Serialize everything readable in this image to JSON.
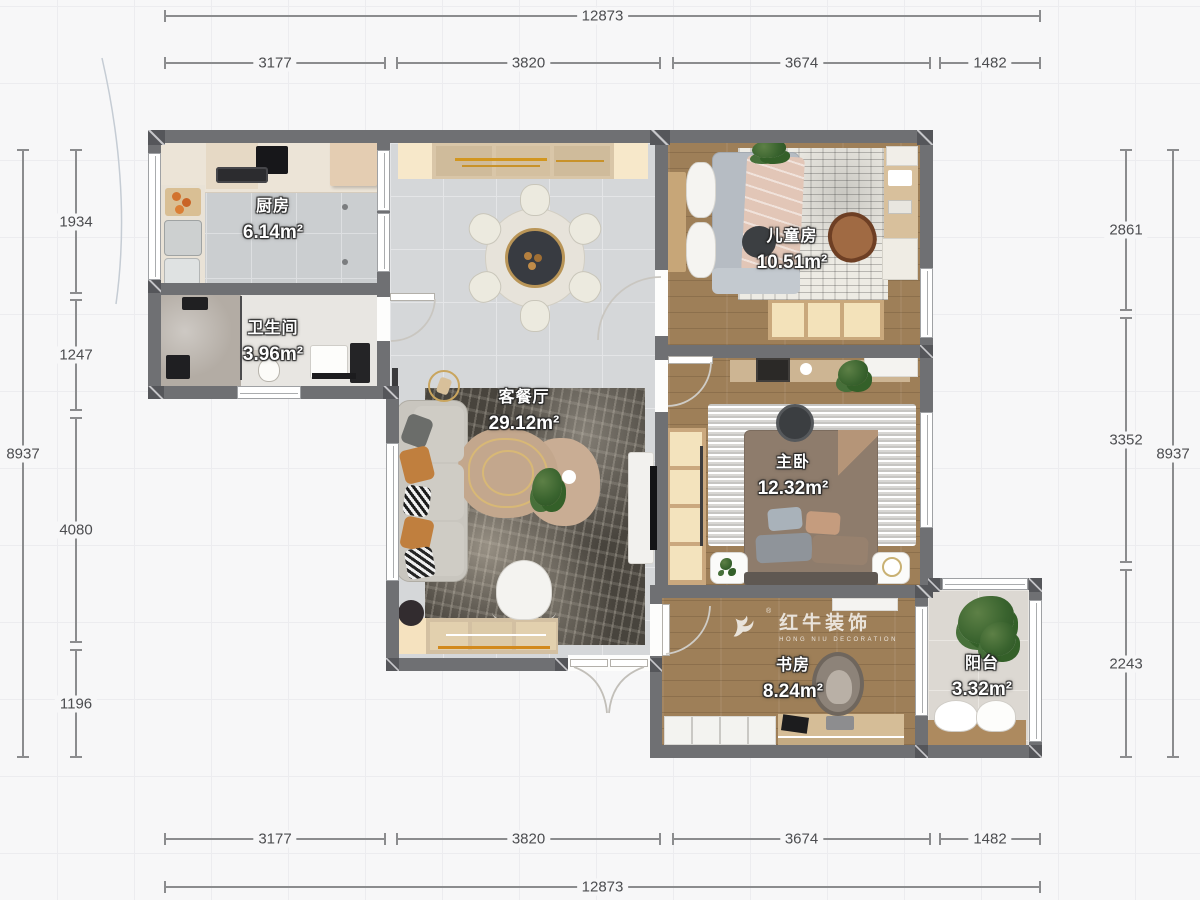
{
  "watermark": {
    "cn": "红牛装饰",
    "en": "HONG NIU DECORATION",
    "reg": "®"
  },
  "dims": {
    "top_total": "12873",
    "top_segments": [
      "3177",
      "3820",
      "3674",
      "1482"
    ],
    "bottom_segments": [
      "3177",
      "3820",
      "3674",
      "1482"
    ],
    "bottom_total": "12873",
    "left_total": "8937",
    "left_segments": [
      "1934",
      "1247",
      "4080",
      "1196"
    ],
    "right_total": "8937",
    "right_segments": [
      "2861",
      "3352",
      "2243"
    ]
  },
  "rooms": {
    "kitchen": {
      "name": "厨房",
      "area": "6.14m²"
    },
    "bathroom": {
      "name": "卫生间",
      "area": "3.96m²"
    },
    "living": {
      "name": "客餐厅",
      "area": "29.12m²"
    },
    "kids": {
      "name": "儿童房",
      "area": "10.51m²"
    },
    "master": {
      "name": "主卧",
      "area": "12.32m²"
    },
    "study": {
      "name": "书房",
      "area": "8.24m²"
    },
    "balcony": {
      "name": "阳台",
      "area": "3.32m²"
    }
  }
}
